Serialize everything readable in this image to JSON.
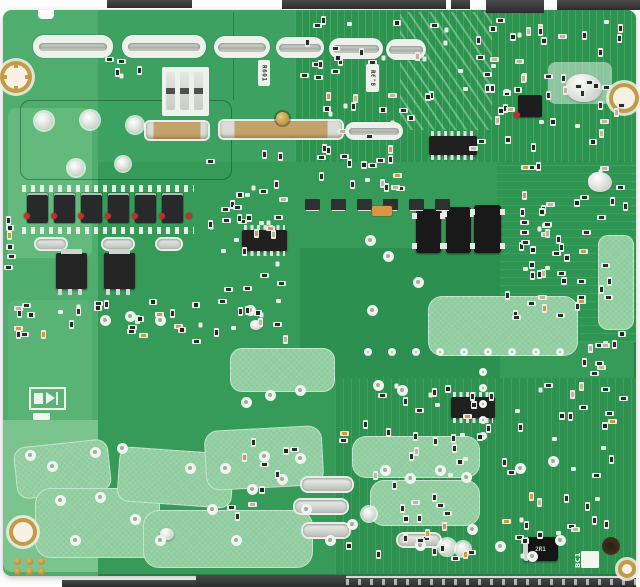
{
  "scene": {
    "type": "photograph",
    "subject": "Top-down photo of a green printed circuit board (power supply PCB) with SMD components, tinned solder slots, bus bars, mounting holes and edge connectors",
    "background_color": "#fbfcfb"
  },
  "labels": {
    "r601": "R601",
    "r608": "R608",
    "bc1": "BC1",
    "d2r1": "2R1"
  },
  "palette": {
    "board_base": "#369b58",
    "board_dark": "#2c944f",
    "copper_pour": "#8fcc9e",
    "silkscreen": "#eef2ec",
    "tinned_silver": "#c9cec7",
    "gold": "#c39a45",
    "component_black": "#202020",
    "glue_red": "#c2302e",
    "cap_orange": "#d89544",
    "connector_dark": "#3a3a3c"
  },
  "top_connectors": [
    {
      "x": 107,
      "w": 85,
      "h": 8
    },
    {
      "x": 282,
      "w": 164,
      "h": 9
    },
    {
      "x": 451,
      "w": 19,
      "h": 9
    },
    {
      "x": 486,
      "w": 58,
      "h": 13
    },
    {
      "x": 557,
      "w": 83,
      "h": 10
    }
  ],
  "bottom_connector": {
    "thin": {
      "x": 62,
      "y": 580,
      "w": 134,
      "h": 7
    },
    "thick": {
      "x": 196,
      "y": 575,
      "w": 150,
      "h": 12
    },
    "pinned": {
      "x": 346,
      "y": 578,
      "w": 290,
      "h": 9
    }
  },
  "components": [
    {
      "t": "slot",
      "x": 33,
      "y": 35,
      "w": 80,
      "h": 23
    },
    {
      "t": "slot",
      "x": 122,
      "y": 35,
      "w": 84,
      "h": 23
    },
    {
      "t": "slot",
      "x": 214,
      "y": 36,
      "w": 56,
      "h": 22
    },
    {
      "t": "slot",
      "x": 276,
      "y": 37,
      "w": 48,
      "h": 21
    },
    {
      "t": "slot",
      "x": 329,
      "y": 38,
      "w": 54,
      "h": 21
    },
    {
      "t": "slot",
      "x": 386,
      "y": 39,
      "w": 40,
      "h": 21
    },
    {
      "t": "slot",
      "x": 345,
      "y": 122,
      "w": 58,
      "h": 18
    },
    {
      "t": "busbar",
      "x": 146,
      "y": 122,
      "w": 62,
      "h": 17
    },
    {
      "t": "busbar",
      "x": 220,
      "y": 121,
      "w": 122,
      "h": 17,
      "stud": 1
    },
    {
      "t": "pill",
      "x": 36,
      "y": 239,
      "w": 30,
      "h": 10
    },
    {
      "t": "pill",
      "x": 103,
      "y": 239,
      "w": 30,
      "h": 10
    },
    {
      "t": "pill",
      "x": 157,
      "y": 239,
      "w": 24,
      "h": 10
    },
    {
      "t": "pill",
      "x": 302,
      "y": 478,
      "w": 50,
      "h": 13
    },
    {
      "t": "pill",
      "x": 295,
      "y": 500,
      "w": 52,
      "h": 13
    },
    {
      "t": "pill",
      "x": 303,
      "y": 524,
      "w": 46,
      "h": 13
    },
    {
      "t": "pill",
      "x": 398,
      "y": 534,
      "w": 42,
      "h": 12
    },
    {
      "t": "padbig",
      "x": 44,
      "y": 121,
      "r": 9
    },
    {
      "t": "padbig",
      "x": 90,
      "y": 120,
      "r": 9
    },
    {
      "t": "padbig",
      "x": 135,
      "y": 125,
      "r": 8
    },
    {
      "t": "padbig",
      "x": 76,
      "y": 168,
      "r": 8
    },
    {
      "t": "padbig",
      "x": 123,
      "y": 164,
      "r": 7
    },
    {
      "t": "padbig",
      "x": 447,
      "y": 547,
      "r": 8
    },
    {
      "t": "padbig",
      "x": 463,
      "y": 549,
      "r": 7
    },
    {
      "t": "padbig",
      "x": 369,
      "y": 514,
      "r": 7
    },
    {
      "t": "hole",
      "x": 16,
      "y": 77,
      "r": 12,
      "cast": 1
    },
    {
      "t": "hole",
      "x": 624,
      "y": 98,
      "r": 11
    },
    {
      "t": "hole",
      "x": 23,
      "y": 532,
      "r": 10
    },
    {
      "t": "hole",
      "x": 627,
      "y": 569,
      "r": 5
    },
    {
      "t": "ticks",
      "x": 22,
      "y": 185,
      "w": 172,
      "h": 7
    },
    {
      "t": "ticks",
      "x": 22,
      "y": 227,
      "w": 172,
      "h": 7
    },
    {
      "t": "fetrow",
      "x": 27,
      "y": 193,
      "n": 6,
      "pitch": 27,
      "w": 21,
      "h": 30
    },
    {
      "t": "dots",
      "x": 24,
      "y": 213,
      "n": 7,
      "pitch": 27
    },
    {
      "t": "pfet",
      "x": 56,
      "y": 253,
      "w": 31,
      "h": 36
    },
    {
      "t": "pfet",
      "x": 104,
      "y": 253,
      "w": 31,
      "h": 36
    },
    {
      "t": "ic",
      "x": 429,
      "y": 136,
      "w": 48,
      "h": 19
    },
    {
      "t": "ic",
      "x": 242,
      "y": 230,
      "w": 45,
      "h": 21
    },
    {
      "t": "ic",
      "x": 451,
      "y": 397,
      "w": 44,
      "h": 21
    },
    {
      "t": "chip",
      "x": 518,
      "y": 95,
      "w": 24,
      "h": 22
    },
    {
      "t": "dot",
      "x": 514,
      "y": 112
    },
    {
      "t": "opto",
      "x": 416,
      "y": 209,
      "w": 25,
      "h": 44
    },
    {
      "t": "opto",
      "x": 446,
      "y": 207,
      "w": 25,
      "h": 46
    },
    {
      "t": "opto",
      "x": 474,
      "y": 205,
      "w": 27,
      "h": 48
    },
    {
      "t": "sotrow",
      "x": 305,
      "y": 199,
      "n": 6,
      "pitch": 26,
      "w": 15,
      "h": 11
    },
    {
      "t": "orange",
      "x": 372,
      "y": 206,
      "w": 20,
      "h": 10
    },
    {
      "t": "blob",
      "x": 588,
      "y": 172,
      "w": 24,
      "h": 20
    },
    {
      "t": "blob",
      "x": 566,
      "y": 74,
      "w": 36,
      "h": 28
    },
    {
      "t": "blob",
      "x": 160,
      "y": 528,
      "w": 14,
      "h": 12
    },
    {
      "t": "blob",
      "x": 250,
      "y": 320,
      "w": 12,
      "h": 10
    },
    {
      "t": "label",
      "key": "r601",
      "x": 258,
      "y": 60,
      "w": 12,
      "h": 26
    },
    {
      "t": "label",
      "key": "r608",
      "x": 366,
      "y": 64,
      "w": 13,
      "h": 28
    },
    {
      "t": "sktext",
      "key": "bc1",
      "x": 572,
      "y": 549,
      "w": 12,
      "h": 22
    },
    {
      "t": "bdiode",
      "key": "d2r1",
      "x": 523,
      "y": 537,
      "w": 35,
      "h": 24
    },
    {
      "t": "wsq",
      "x": 581,
      "y": 551,
      "w": 18,
      "h": 17
    },
    {
      "t": "dhole",
      "x": 611,
      "y": 546,
      "r": 9
    },
    {
      "t": "goldpads",
      "x": 14,
      "y": 558,
      "cols": 3,
      "rows": 2,
      "pitch": 12,
      "d": 7
    },
    {
      "t": "dsym",
      "x": 29,
      "y": 387,
      "w": 37,
      "h": 23
    },
    {
      "t": "wsq",
      "x": 33,
      "y": 413,
      "w": 17,
      "h": 7
    },
    {
      "t": "jblock",
      "x": 162,
      "y": 67,
      "w": 47,
      "h": 49
    },
    {
      "t": "padrow",
      "x": 368,
      "y": 352,
      "n": 9,
      "pitch": 24,
      "d": 8
    },
    {
      "t": "padcol",
      "x": 483,
      "y": 372,
      "n": 5,
      "pitch": 16,
      "d": 8
    },
    {
      "t": "pads",
      "d": 11,
      "list": [
        [
          30,
          455
        ],
        [
          52,
          466
        ],
        [
          95,
          452
        ],
        [
          122,
          448
        ],
        [
          60,
          500
        ],
        [
          100,
          497
        ],
        [
          135,
          519
        ],
        [
          75,
          540
        ],
        [
          160,
          540
        ],
        [
          190,
          468
        ],
        [
          212,
          509
        ],
        [
          236,
          540
        ],
        [
          252,
          489
        ],
        [
          282,
          479
        ],
        [
          306,
          509
        ],
        [
          330,
          540
        ],
        [
          300,
          458
        ],
        [
          264,
          456
        ],
        [
          225,
          468
        ],
        [
          440,
          470
        ],
        [
          466,
          477
        ],
        [
          520,
          468
        ],
        [
          553,
          461
        ],
        [
          472,
          529
        ],
        [
          500,
          546
        ],
        [
          532,
          556
        ],
        [
          560,
          540
        ],
        [
          420,
          545
        ],
        [
          352,
          524
        ],
        [
          385,
          470
        ],
        [
          410,
          478
        ],
        [
          370,
          240
        ],
        [
          388,
          256
        ],
        [
          418,
          282
        ],
        [
          372,
          310
        ],
        [
          250,
          310
        ],
        [
          378,
          385
        ],
        [
          402,
          390
        ],
        [
          300,
          390
        ],
        [
          270,
          395
        ],
        [
          246,
          402
        ],
        [
          160,
          320
        ],
        [
          130,
          316
        ],
        [
          105,
          320
        ]
      ]
    },
    {
      "t": "smds",
      "x": 300,
      "y": 18,
      "w": 330,
      "h": 138,
      "n": 95,
      "seed": 7
    },
    {
      "t": "smds",
      "x": 498,
      "y": 162,
      "w": 136,
      "h": 168,
      "n": 55,
      "seed": 13
    },
    {
      "t": "smds",
      "x": 196,
      "y": 152,
      "w": 104,
      "h": 145,
      "n": 32,
      "seed": 21
    },
    {
      "t": "smds",
      "x": 300,
      "y": 152,
      "w": 118,
      "h": 46,
      "n": 15,
      "seed": 5
    },
    {
      "t": "smds",
      "x": 338,
      "y": 382,
      "w": 296,
      "h": 184,
      "n": 88,
      "seed": 31
    },
    {
      "t": "smds",
      "x": 6,
      "y": 298,
      "w": 184,
      "h": 45,
      "n": 26,
      "seed": 17
    },
    {
      "t": "smds",
      "x": 190,
      "y": 295,
      "w": 118,
      "h": 54,
      "n": 14,
      "seed": 11
    },
    {
      "t": "smds",
      "x": 580,
      "y": 330,
      "w": 54,
      "h": 58,
      "n": 10,
      "seed": 3
    },
    {
      "t": "smds",
      "x": 200,
      "y": 432,
      "w": 108,
      "h": 96,
      "n": 10,
      "seed": 9
    },
    {
      "t": "smds",
      "x": 4,
      "y": 215,
      "w": 18,
      "h": 58,
      "n": 6,
      "seed": 41
    },
    {
      "t": "smds",
      "x": 100,
      "y": 55,
      "w": 55,
      "h": 28,
      "n": 5,
      "seed": 23
    }
  ]
}
